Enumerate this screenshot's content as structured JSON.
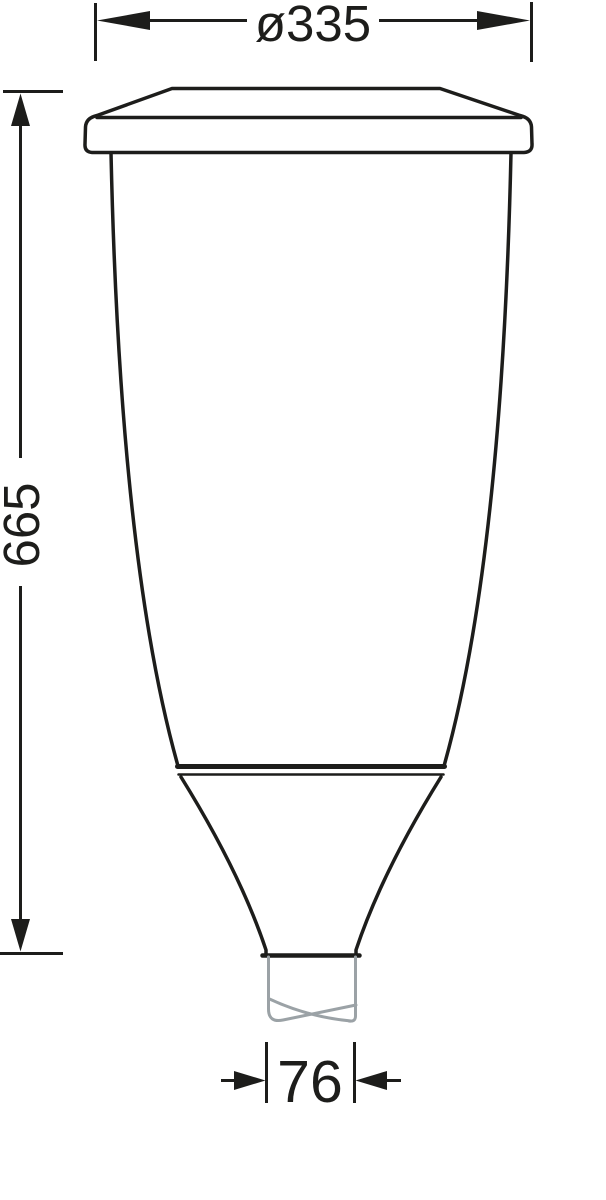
{
  "drawing": {
    "title": "Luminaire dimension drawing",
    "background_color": "#ffffff",
    "line_color": "#1d1d1b",
    "pole_color": "#9ba2a6",
    "dimensions": [
      {
        "id": "top-diameter",
        "label": "ø335",
        "value": 335,
        "unit": "mm",
        "orientation": "horizontal"
      },
      {
        "id": "overall-height",
        "label": "665",
        "value": 665,
        "unit": "mm",
        "orientation": "vertical"
      },
      {
        "id": "spigot-width",
        "label": "76",
        "value": 76,
        "unit": "mm",
        "orientation": "horizontal"
      }
    ]
  }
}
